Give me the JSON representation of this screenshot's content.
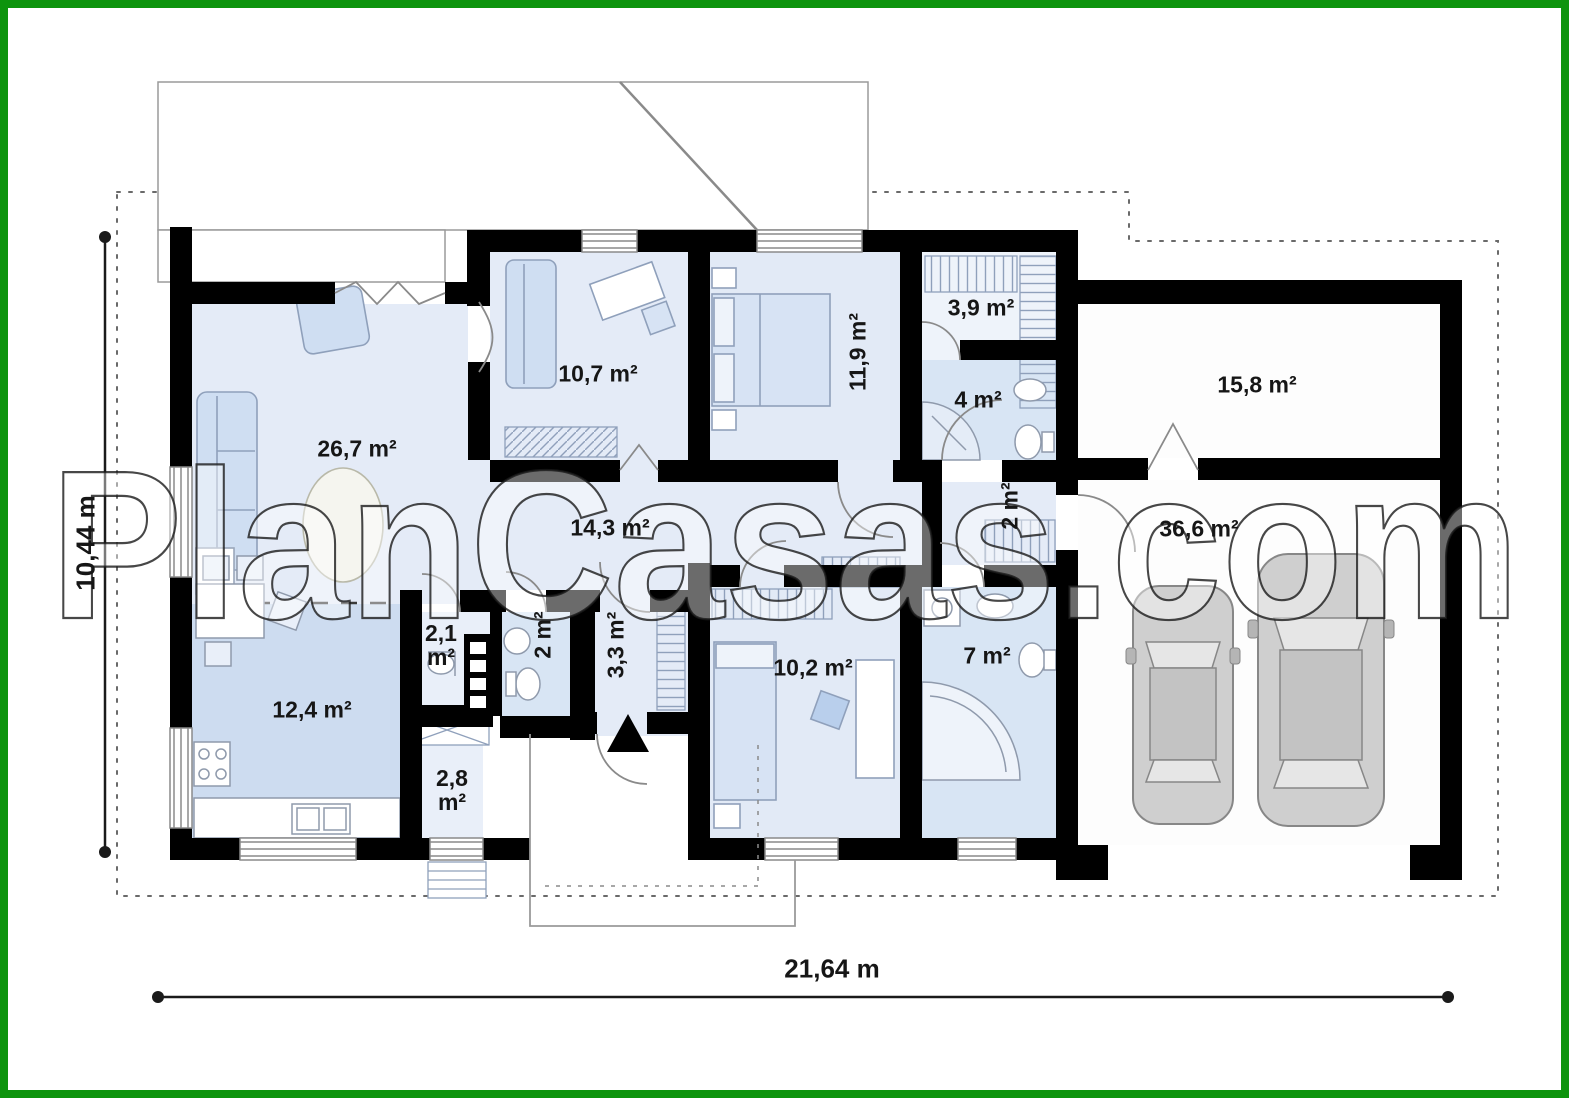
{
  "watermark": "PlanCasas.com",
  "dimensions": {
    "width_label": "21,64 m",
    "height_label": "10,44 m"
  },
  "rooms": {
    "living": {
      "label": "26,7 m²"
    },
    "office": {
      "label": "10,7 m²"
    },
    "bedroom_top": {
      "label": "11,9 m²"
    },
    "wardrobe": {
      "label": "3,9 m²"
    },
    "bathroom_top": {
      "label": "4 m²"
    },
    "storage": {
      "label": "15,8 m²"
    },
    "hallway": {
      "label": "14,3 m²"
    },
    "garage_lobby": {
      "label": "2 m²"
    },
    "garage": {
      "label": "36,6 m²"
    },
    "wc": {
      "label": "2,1 m²"
    },
    "bathroom_small": {
      "label": "2 m²"
    },
    "vestibule": {
      "label": "3,3 m²"
    },
    "bedroom_bottom": {
      "label": "10,2 m²"
    },
    "bathroom_bottom": {
      "label": "7 m²"
    },
    "kitchen": {
      "label": "12,4 m²"
    },
    "pantry": {
      "label": "2,8 m²"
    }
  }
}
